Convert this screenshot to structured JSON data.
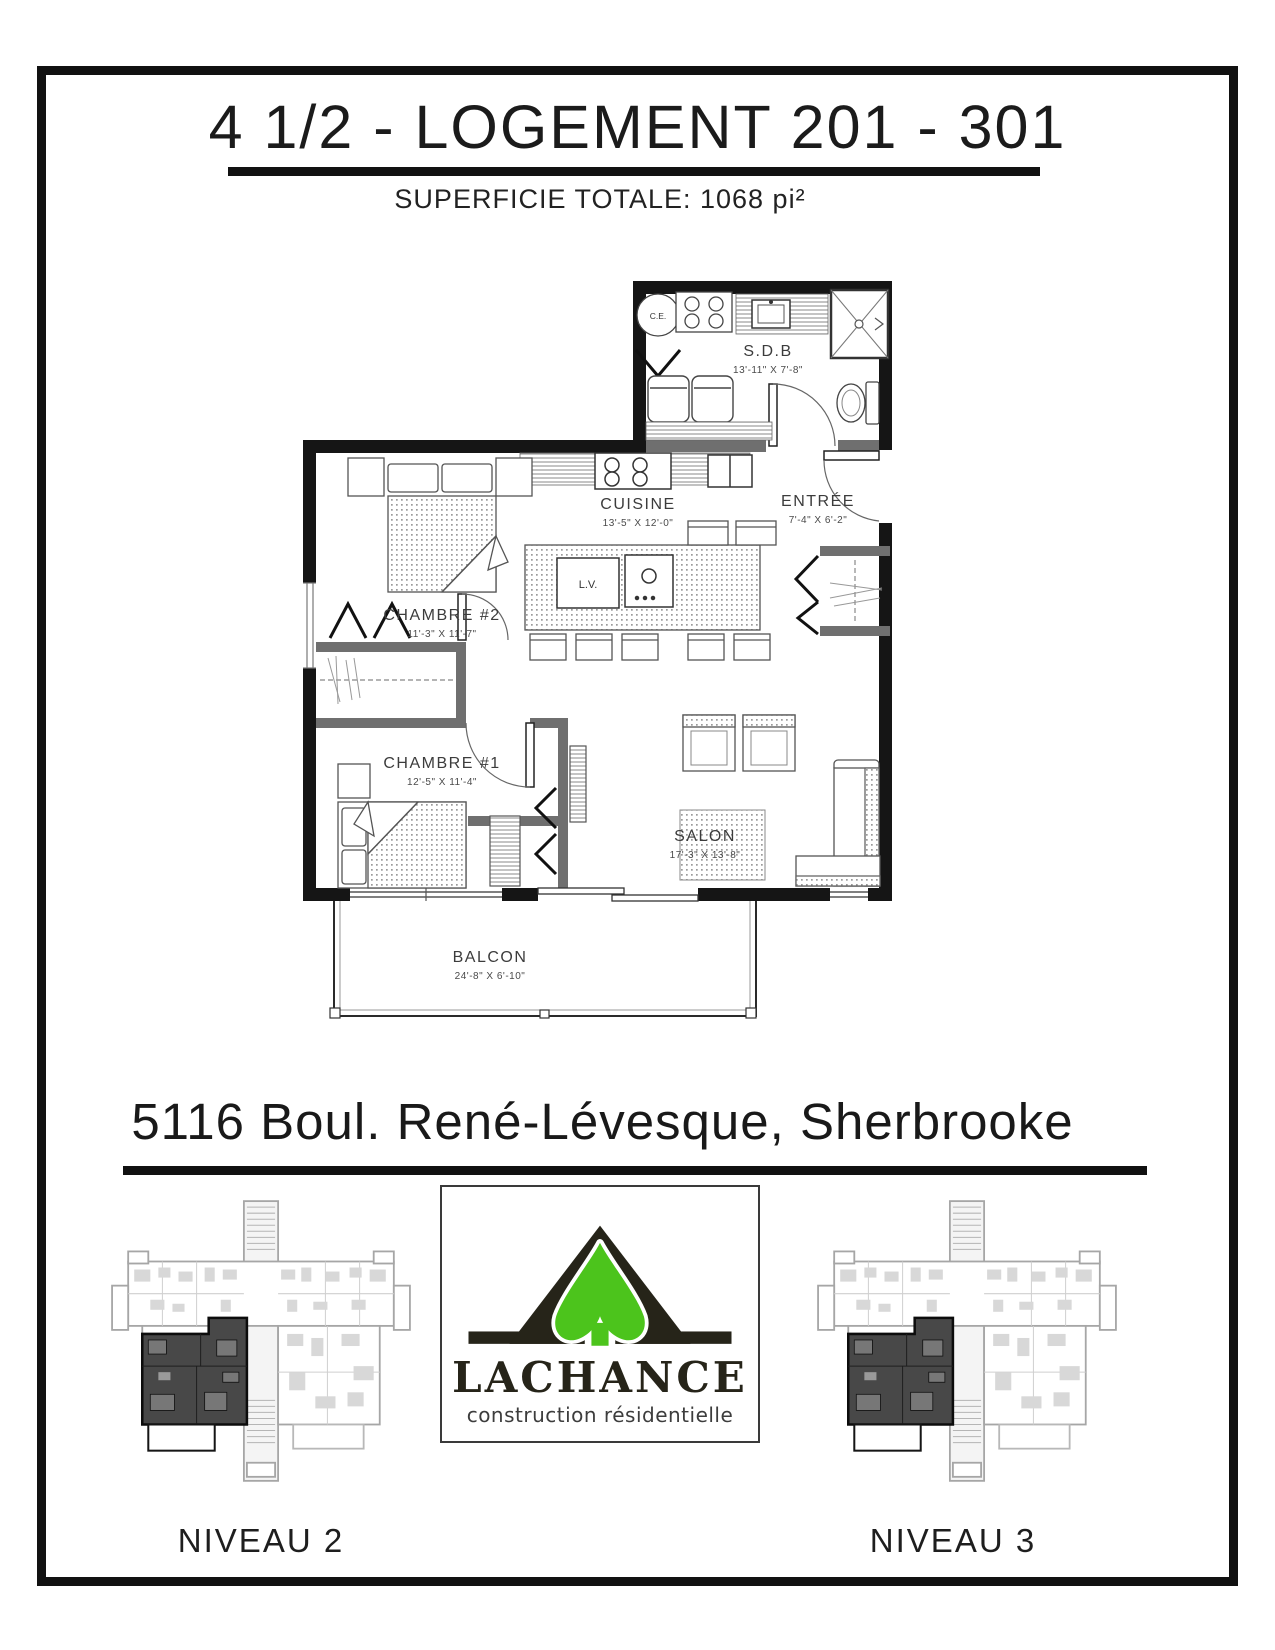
{
  "header": {
    "title": "4 1/2 - LOGEMENT 201 - 301",
    "subtitle": "SUPERFICIE TOTALE: 1068 pi²"
  },
  "address": "5116 Boul. René-Lévesque, Sherbrooke",
  "floorplan": {
    "rooms": [
      {
        "name": "S.D.B",
        "dims": "13'-11\" X 7'-8\""
      },
      {
        "name": "CUISINE",
        "dims": "13'-5\" X 12'-0\""
      },
      {
        "name": "ENTRÉE",
        "dims": "7'-4\" X 6'-2\""
      },
      {
        "name": "CHAMBRE #2",
        "dims": "11'-3\" X 11'-7\""
      },
      {
        "name": "CHAMBRE #1",
        "dims": "12'-5\" X 11'-4\""
      },
      {
        "name": "SALON",
        "dims": "17'-3\" X 13'-8\""
      },
      {
        "name": "BALCON",
        "dims": "24'-8\" X 6'-10\""
      }
    ],
    "labels": {
      "water_heater": "C.E.",
      "dishwasher": "L.V."
    }
  },
  "logo": {
    "brand": "LACHANCE",
    "tagline": "construction résidentielle",
    "colors": {
      "green": "#4cc41c",
      "dark": "#262419"
    }
  },
  "levels": [
    {
      "label": "NIVEAU 2"
    },
    {
      "label": "NIVEAU 3"
    }
  ]
}
